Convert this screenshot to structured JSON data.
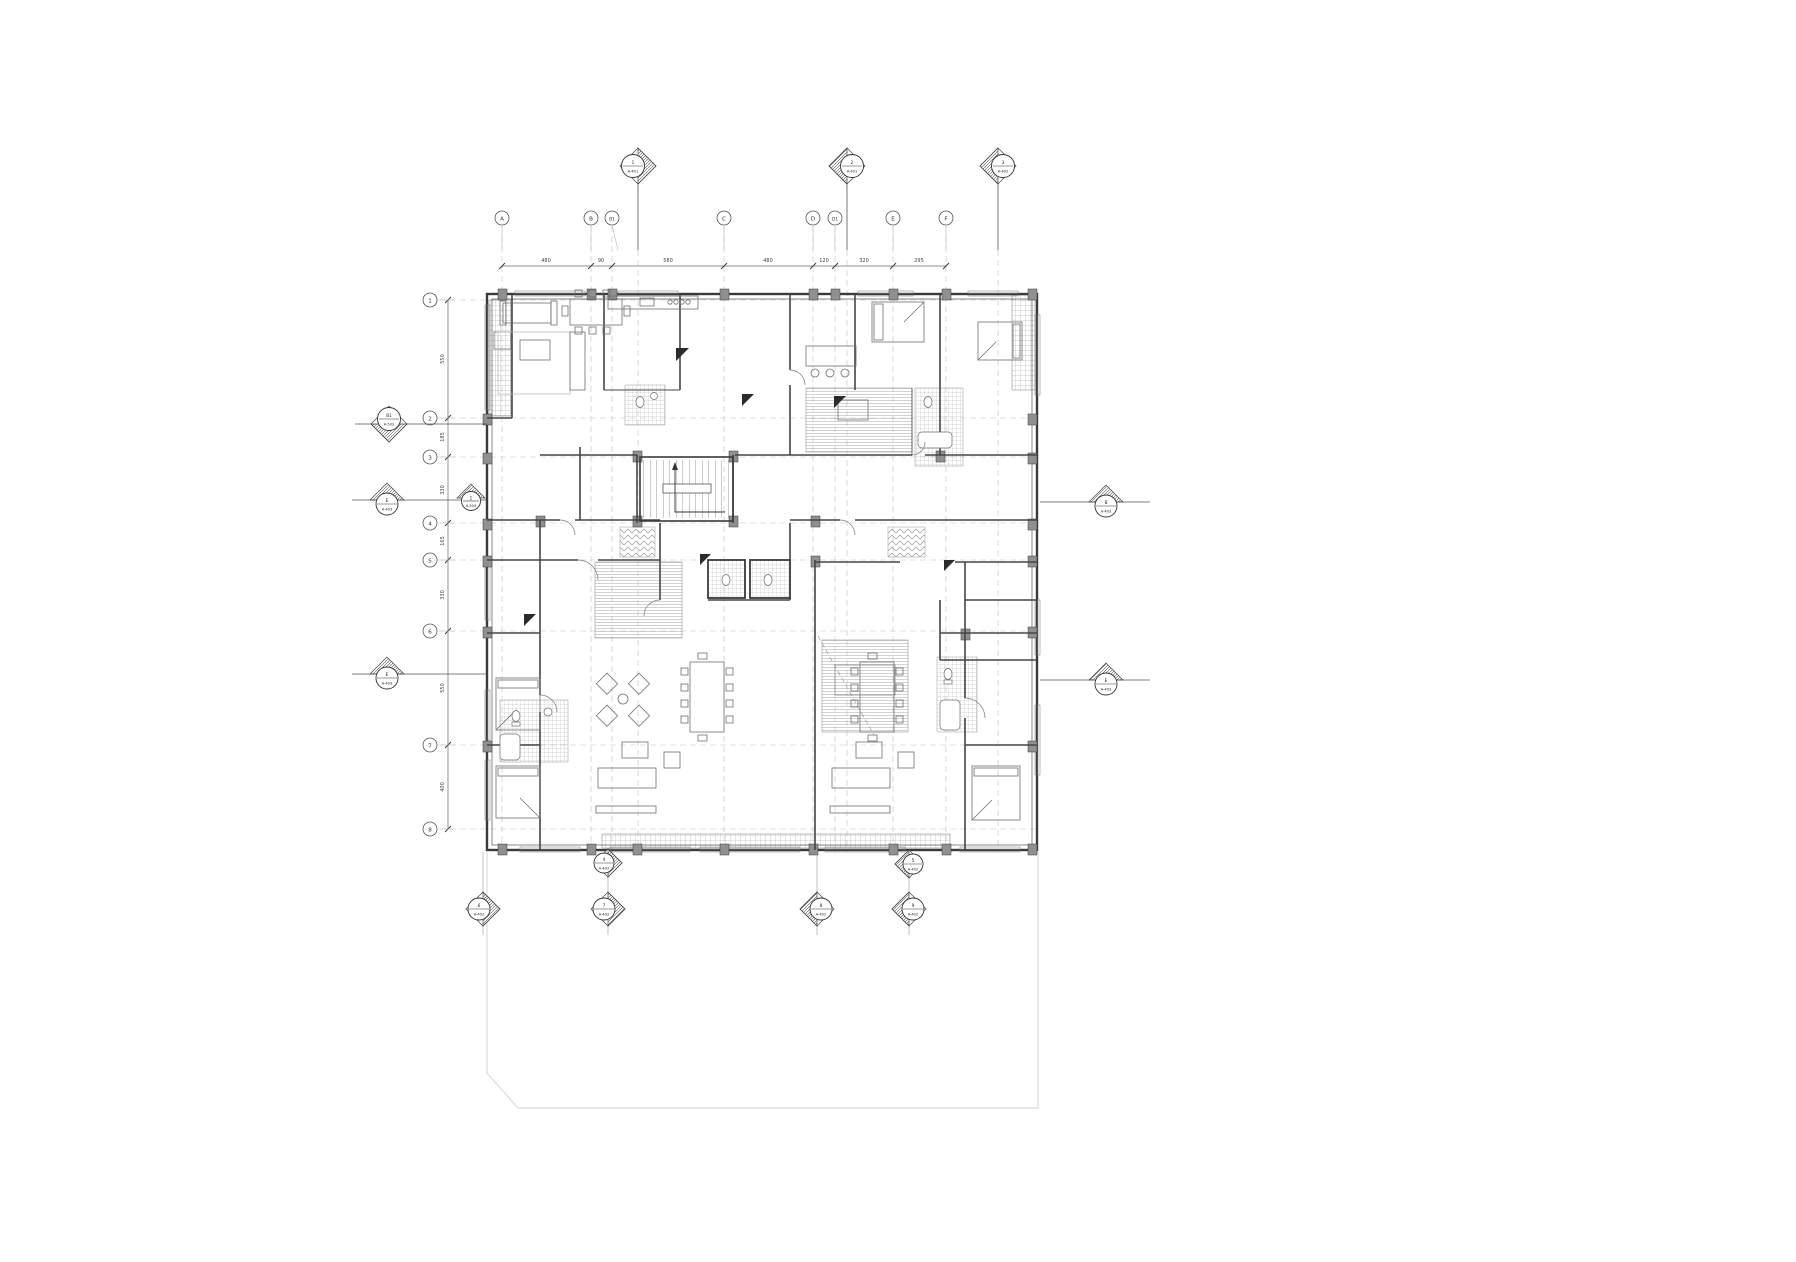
{
  "page": {
    "background": "#ffffff",
    "wall_color": "#3a3a3a",
    "faint_color": "#d9d9d9",
    "grid_dash_color": "#b8b8b8",
    "column_fill": "#909090"
  },
  "grid_columns": [
    {
      "label": "A"
    },
    {
      "label": "B"
    },
    {
      "label": "B1"
    },
    {
      "label": "C"
    },
    {
      "label": "D"
    },
    {
      "label": "D1"
    },
    {
      "label": "E"
    },
    {
      "label": "F"
    }
  ],
  "grid_rows": [
    {
      "label": "1"
    },
    {
      "label": "2"
    },
    {
      "label": "3"
    },
    {
      "label": "4"
    },
    {
      "label": "5"
    },
    {
      "label": "6"
    },
    {
      "label": "7"
    },
    {
      "label": "8"
    }
  ],
  "dims_top": [
    {
      "value": "480"
    },
    {
      "value": "90"
    },
    {
      "value": "580"
    },
    {
      "value": "480"
    },
    {
      "value": "120"
    },
    {
      "value": "320"
    },
    {
      "value": "295"
    }
  ],
  "dims_left": [
    {
      "value": "550"
    },
    {
      "value": "185"
    },
    {
      "value": "330"
    },
    {
      "value": "165"
    },
    {
      "value": "330"
    },
    {
      "value": "550"
    },
    {
      "value": "400"
    }
  ],
  "section_markers": {
    "top": [
      {
        "num": "1",
        "sheet": "A-401"
      },
      {
        "num": "2",
        "sheet": "A-401"
      },
      {
        "num": "3",
        "sheet": "A-402"
      }
    ],
    "left": [
      {
        "num": "B1",
        "sheet": "A-503"
      },
      {
        "num": "E",
        "sheet": "A-403"
      },
      {
        "num": "1",
        "sheet": "A-503"
      },
      {
        "num": "E",
        "sheet": "A-403"
      }
    ],
    "right": [
      {
        "num": "B",
        "sheet": "A-403"
      },
      {
        "num": "E",
        "sheet": "A-403"
      }
    ],
    "bottom": [
      {
        "num": "4",
        "sheet": "A-402"
      },
      {
        "num": "5",
        "sheet": "A-402"
      },
      {
        "num": "6",
        "sheet": "A-402"
      },
      {
        "num": "7",
        "sheet": "A-402"
      },
      {
        "num": "8",
        "sheet": "A-402"
      },
      {
        "num": "9",
        "sheet": "A-402"
      }
    ]
  }
}
